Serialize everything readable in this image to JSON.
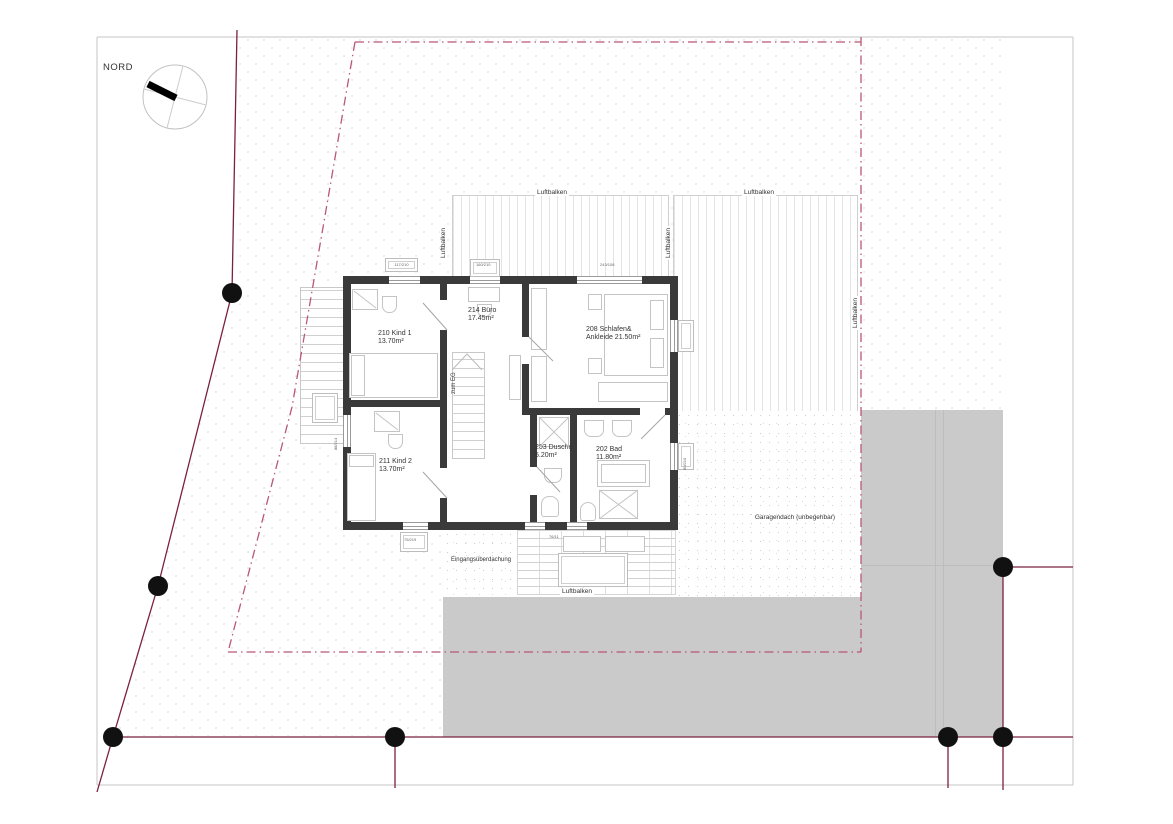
{
  "compass": {
    "label": "NORD"
  },
  "rooms": [
    {
      "name": "210 Kind 1",
      "area": "13.70m²"
    },
    {
      "name": "214 Büro",
      "area": "17.45m²"
    },
    {
      "name": "208 Schlafen&",
      "area": "Ankleide 21.50m²"
    },
    {
      "name": "211 Kind 2",
      "area": "13.70m²"
    },
    {
      "name": "203 Dusche",
      "area": "5.20m²"
    },
    {
      "name": "202 Bad",
      "area": "11.80m²"
    }
  ],
  "annotations": {
    "stair_to_ground_floor": "zum EG",
    "garage_roof": "Garagendach (unbegehbar)",
    "entrance_canopy": "Eingangsüberdachung",
    "air_beam": "Luftbalken"
  },
  "window_dimensions": [
    "117/210",
    "160/210",
    "243/108",
    "75/219",
    "76/11",
    "80/210",
    "88/214"
  ],
  "colors": {
    "site_boundary": "#7b2140",
    "building_envelope_dashed": "#b95873",
    "wall": "#3a3a3a",
    "paving_gray": "#cacaca",
    "boundary_point": "#111111"
  }
}
